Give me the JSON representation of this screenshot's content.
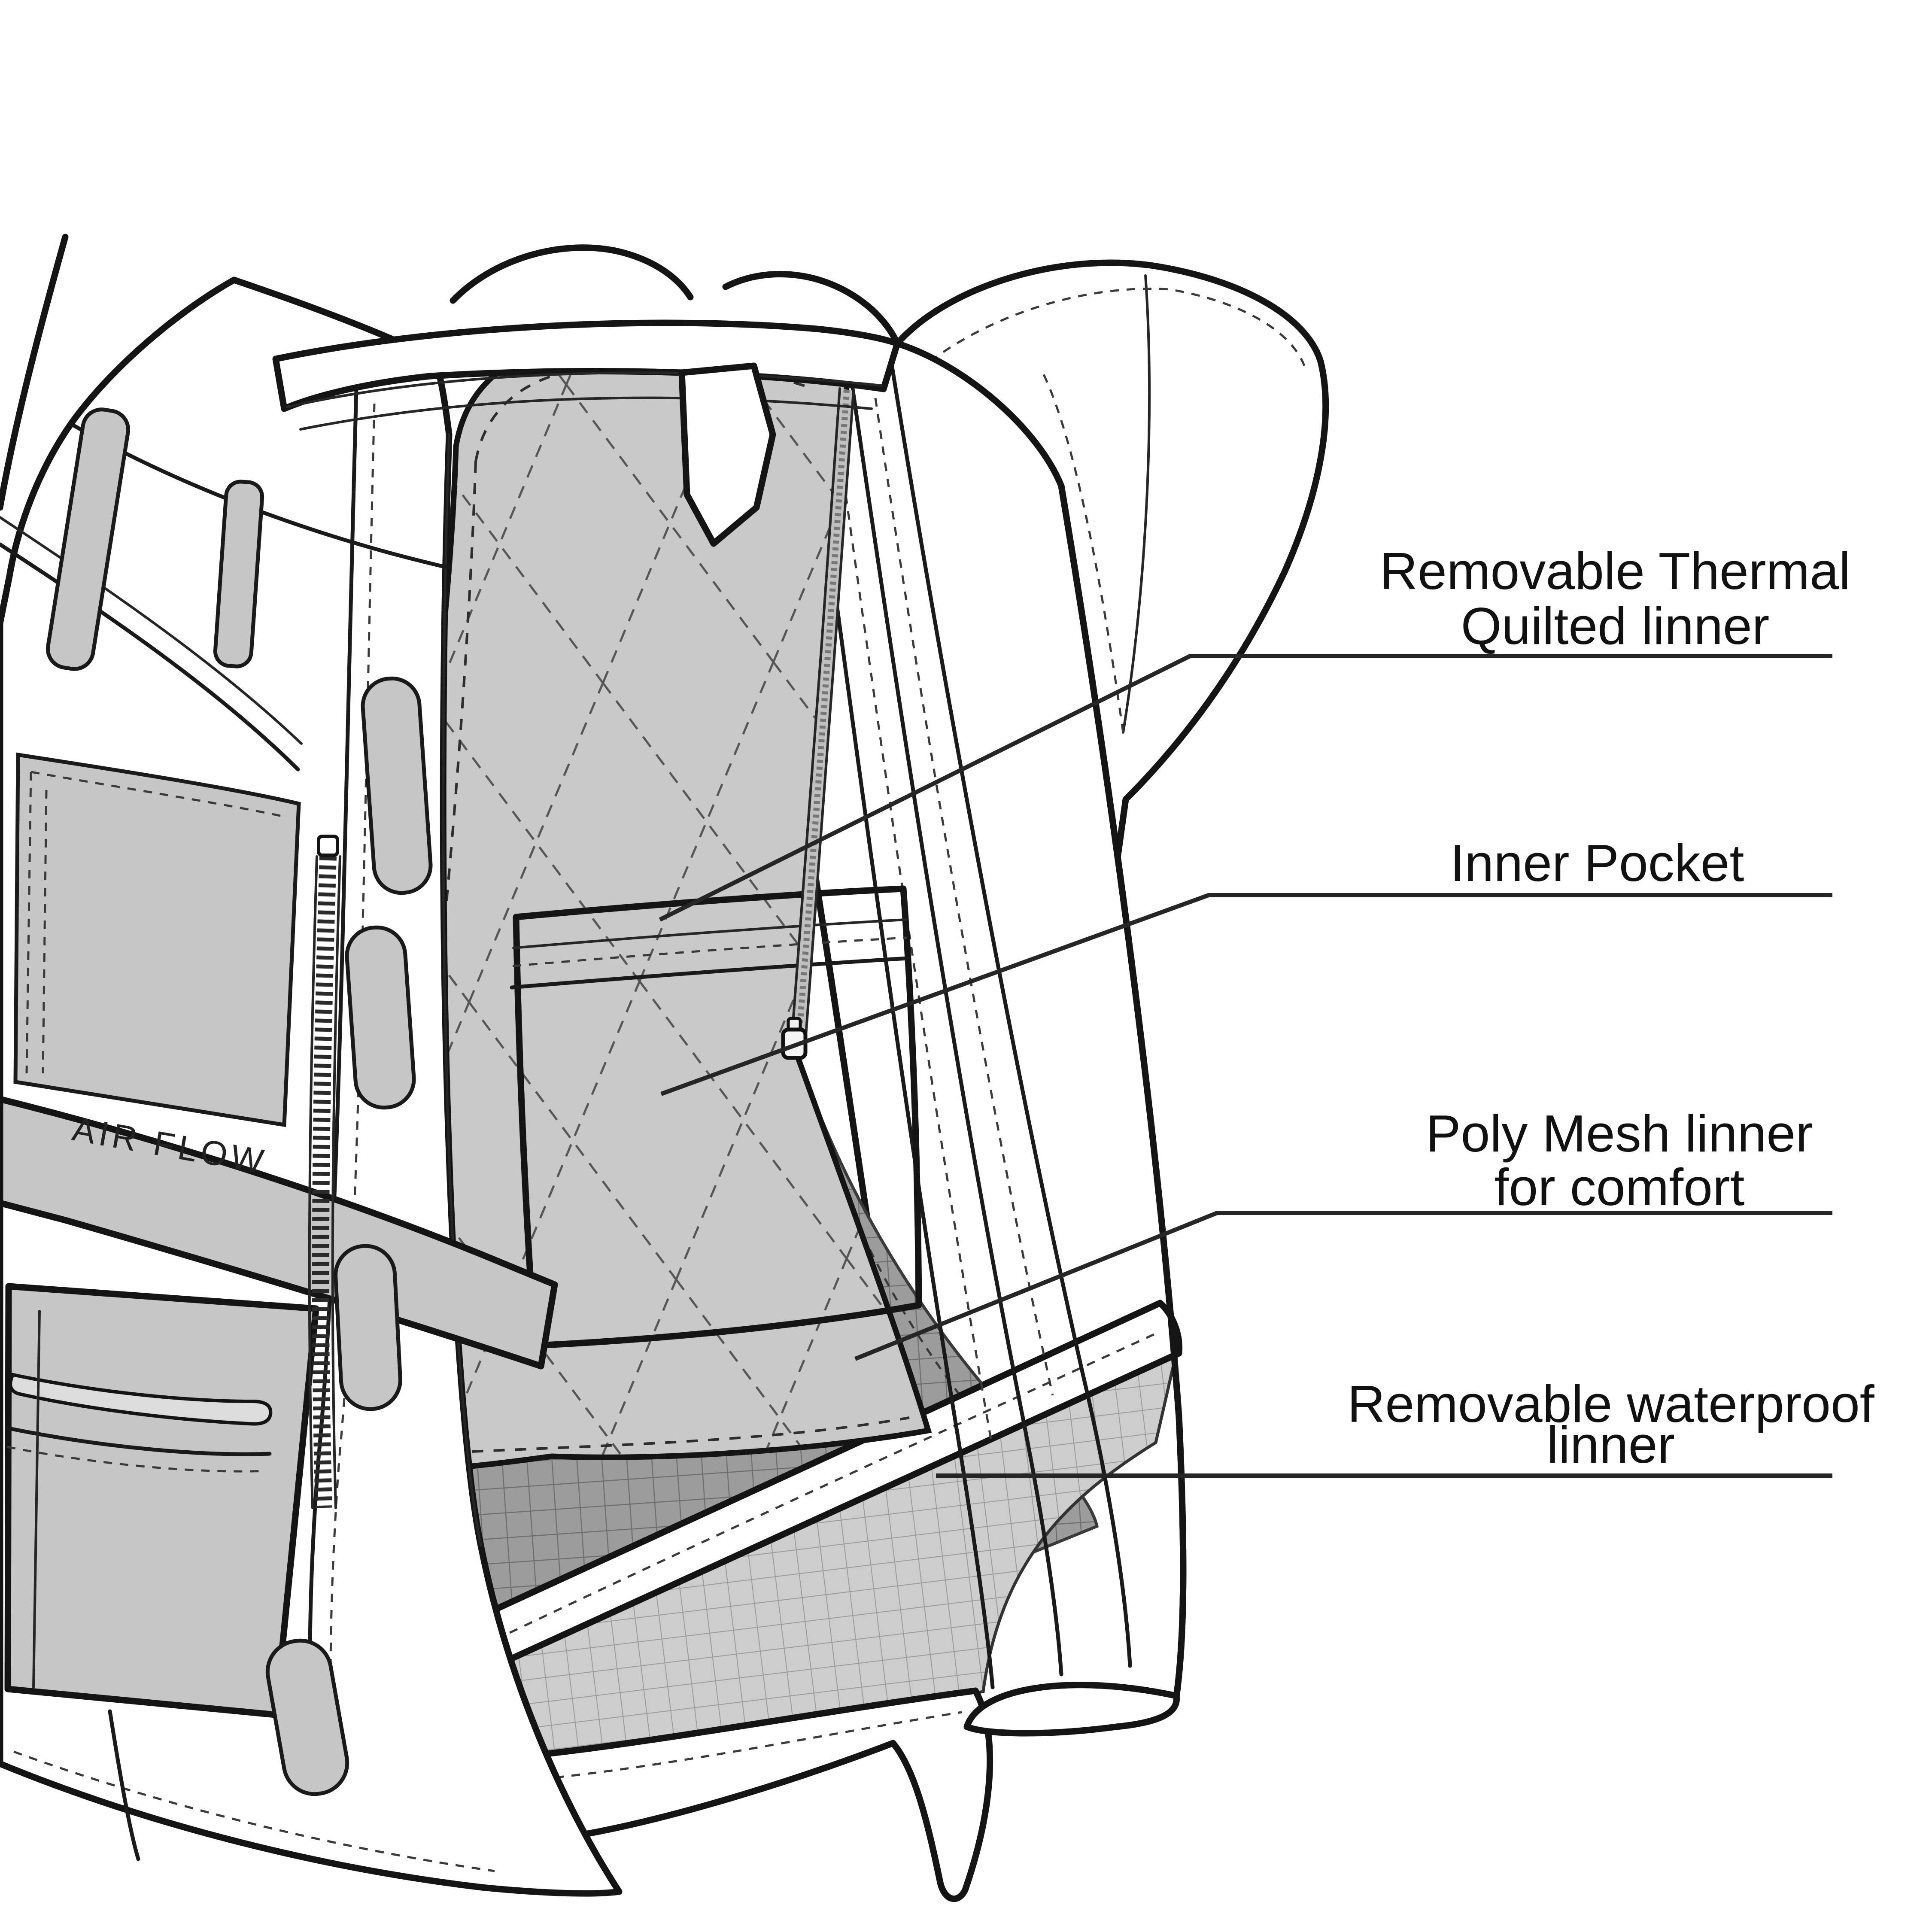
{
  "diagram": {
    "title_hidden": "",
    "background": "#ffffff",
    "ink": "#141414",
    "panel_gray": "#c6c6c6",
    "liner_gray": "#c9c9c9",
    "pull_gray": "#dcdcdc",
    "mesh_dark_bg": "#9c9c9c",
    "mesh_dark_line": "#6f6f6f",
    "mesh_light_bg": "#cdcdcd",
    "mesh_light_line": "#9b9b9b",
    "leader_color": "#262626",
    "label_color": "#111111"
  },
  "jacket": {
    "airflow_text": "AIR FLOW"
  },
  "callouts": [
    {
      "id": "thermal-quilted-liner",
      "lines": [
        "Removable  Thermal",
        "Quilted linner"
      ]
    },
    {
      "id": "inner-pocket",
      "lines": [
        "Inner Pocket"
      ]
    },
    {
      "id": "poly-mesh-liner",
      "lines": [
        "Poly Mesh linner",
        "for comfort"
      ]
    },
    {
      "id": "waterproof-liner",
      "lines": [
        "Removable waterproof",
        "linner"
      ]
    }
  ]
}
